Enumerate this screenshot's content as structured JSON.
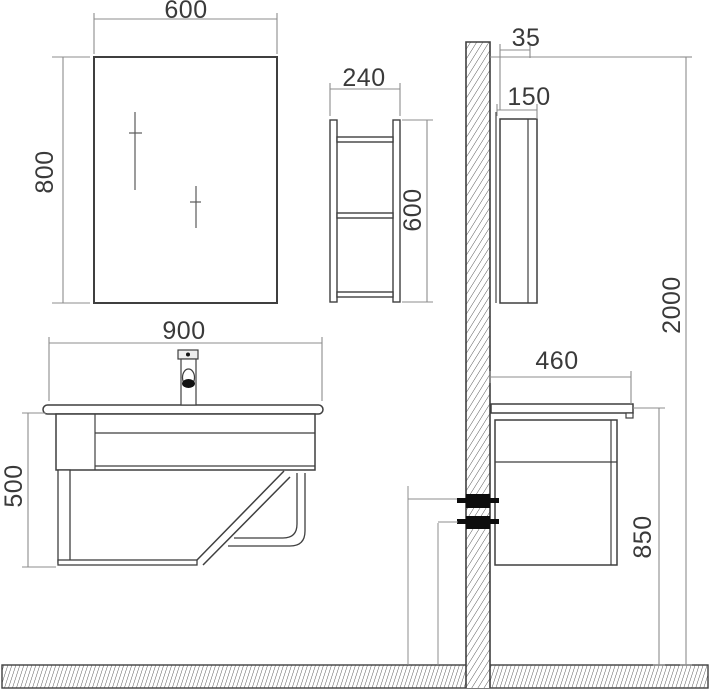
{
  "dimensions": {
    "mirror": {
      "width": "600",
      "height": "800"
    },
    "side_shelf": {
      "width": "240",
      "height": "600",
      "depth": "150",
      "wall_gap": "35"
    },
    "wall": {
      "height": "2000"
    },
    "vanity": {
      "width": "900",
      "height": "500",
      "depth": "460",
      "counter_height": "850"
    }
  },
  "colors": {
    "object_line": "#3f3f3f",
    "dimension_line": "#8c8c8c",
    "label_text": "#3a3a3a",
    "solid_fill": "#0d0d0d"
  }
}
